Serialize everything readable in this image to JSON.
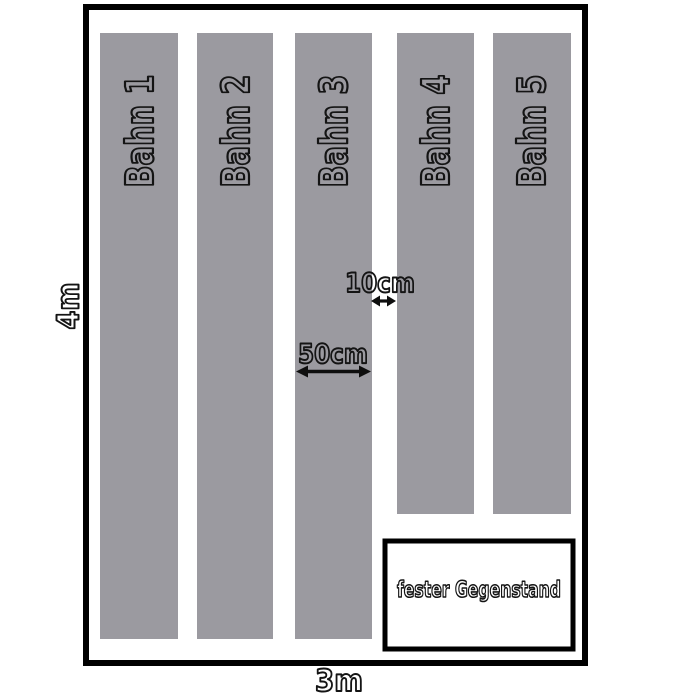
{
  "field": {
    "height_label": "4m",
    "width_label": "3m"
  },
  "lanes": [
    {
      "label": "Bahn 1"
    },
    {
      "label": "Bahn 2"
    },
    {
      "label": "Bahn 3"
    },
    {
      "label": "Bahn 4"
    },
    {
      "label": "Bahn 5"
    }
  ],
  "measurements": {
    "lane_gap_label": "10cm",
    "lane_width_label": "50cm"
  },
  "obstacle": {
    "label": "fester Gegenstand"
  },
  "colors": {
    "lane_fill": "#9b9aa0",
    "line": "#000000",
    "background": "#ffffff",
    "text_outline": "#141414"
  }
}
